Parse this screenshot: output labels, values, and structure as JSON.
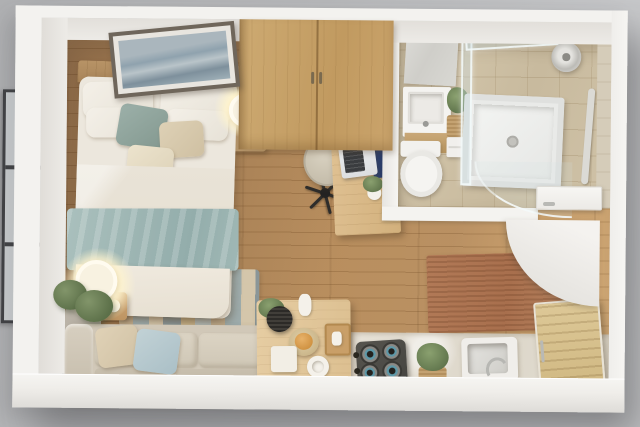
{
  "scene": {
    "type": "3d-floor-plan-render",
    "subject": "studio apartment floor plan, photorealistic top-down 3D render",
    "view": "top-down with slight isometric perspective",
    "visible_text": "none",
    "background_color": "#bcbdbf"
  },
  "palette": {
    "wall_white": "#f3f2ef",
    "wall_inner_face": "#e2dfda",
    "floor_wood": "#b68a58",
    "wardrobe_oak": "#c9a46e",
    "bed_linen": "#ece7dd",
    "throw_blanket_blue": "#9db5b3",
    "accent_cushion_teal": "#8fa49e",
    "sofa_beige": "#d1c8b8",
    "pillow_blue": "#b7c9ce",
    "rug_striped_blue": "#9db0b4",
    "rug_jute_terracotta": "#b07a57",
    "bathroom_tile": "#cfc2a7",
    "counter_marble": "#e2ddd2",
    "cooktop_dark": "#4f4d48",
    "burner_teal": "#5d98a8",
    "laptop_navy": "#2e4470",
    "lamp_glow_warm": "#fff4cf",
    "plant_green": "#5c7049",
    "art_blue_gray": "#8fa2ae",
    "window_frame_dark": "#404144"
  },
  "rooms": [
    {
      "name": "sleeping-area",
      "items": [
        "double-bed",
        "wood-headboard",
        "white-pillows",
        "teal-accent-cushion",
        "beige-accent-cushions",
        "white-duvet",
        "light-blue-throw-blanket",
        "framed-seascape-art",
        "nightstand",
        "glowing-table-lamp",
        "striped-area-rug",
        "left-wall-window"
      ]
    },
    {
      "name": "wardrobe-area",
      "items": [
        "built-in-oak-wardrobe-double-doors"
      ]
    },
    {
      "name": "work-area",
      "items": [
        "wood-desk",
        "open-laptop",
        "desk-plant-top",
        "desk-plant-bottom",
        "beige-swivel-chair"
      ]
    },
    {
      "name": "bathroom",
      "items": [
        "marble-splash-panel",
        "vanity-sink-with-wood-base",
        "storage-drawer-unit",
        "wicker-basket",
        "potted-plant",
        "toilet",
        "walk-in-shower-tray",
        "glass-shower-screen",
        "glass-door-swing",
        "round-shower-head",
        "towel-rail"
      ]
    },
    {
      "name": "living-area",
      "items": [
        "beige-sofa",
        "beige-throw-pillow",
        "blue-throw-pillow",
        "glowing-floor-lamp",
        "tall-potted-plant",
        "wood-side-table",
        "coffee-table",
        "black-plant-pot",
        "white-vase",
        "fruit-bowl",
        "wood-serving-tray",
        "white-storage-box",
        "cup-and-dish"
      ]
    },
    {
      "name": "kitchen",
      "items": [
        "white-stone-counter",
        "four-burner-gas-cooktop",
        "control-knobs",
        "herb-plant-in-planter",
        "undermount-sink",
        "curved-faucet",
        "slatted-wood-cabinet",
        "terracotta-jute-rug"
      ]
    },
    {
      "name": "entrance",
      "items": [
        "white-entry-door-slab",
        "door-handle",
        "door-swing-arc"
      ]
    }
  ]
}
